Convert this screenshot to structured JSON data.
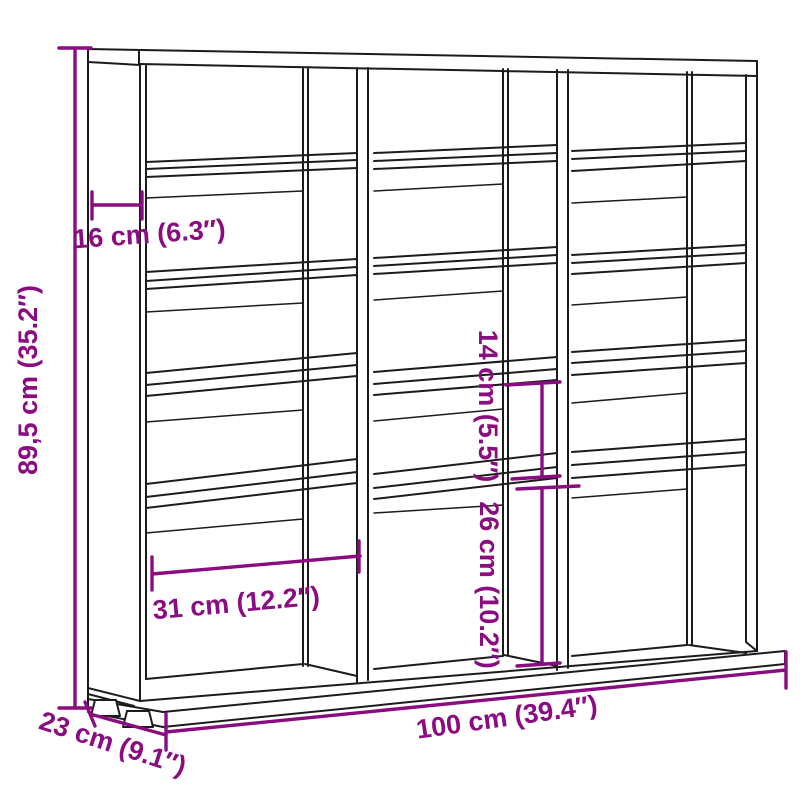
{
  "diagram": {
    "type": "product-dimension-diagram",
    "product": "3-column shelving unit (CD rack)",
    "colors": {
      "accent": "#8b0b80",
      "line": "#1c1c1c",
      "background": "#ffffff"
    },
    "dimensions": {
      "height": {
        "label": "89,5 cm (35.2″)",
        "value_cm": 89.5,
        "orientation": "vertical-left"
      },
      "top_depth": {
        "label": "16 cm (6.3″)",
        "value_cm": 16,
        "orientation": "horizontal-top-left"
      },
      "shelf_gap_small": {
        "label": "14 cm (5.5″)",
        "value_cm": 14,
        "orientation": "vertical-middle"
      },
      "shelf_gap_large": {
        "label": "26 cm (10.2″)",
        "value_cm": 26,
        "orientation": "vertical-middle"
      },
      "compartment_width": {
        "label": "31 cm (12.2″)",
        "value_cm": 31,
        "orientation": "horizontal-lower-left"
      },
      "total_width": {
        "label": "100 cm (39.4″)",
        "value_cm": 100,
        "orientation": "horizontal-bottom"
      },
      "base_depth": {
        "label": "23 cm (9.1″)",
        "value_cm": 23,
        "orientation": "diagonal-bottom-left"
      }
    }
  }
}
